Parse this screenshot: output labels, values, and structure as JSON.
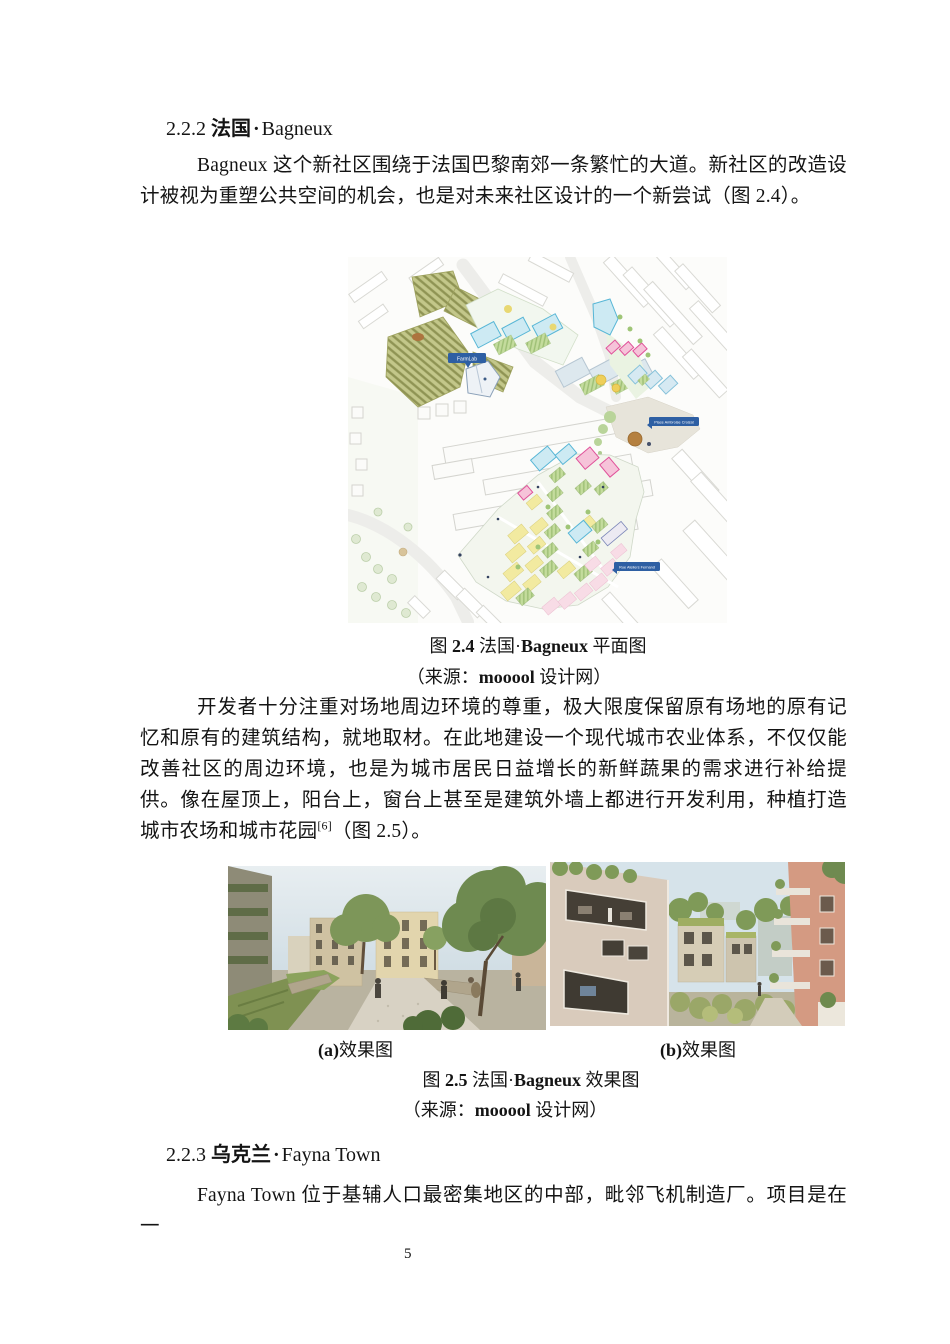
{
  "page": {
    "number": "5"
  },
  "headings": {
    "s222": {
      "num": "2.2.2 ",
      "cn": "法国",
      "sep": "·",
      "en": "Bagneux"
    },
    "s223": {
      "num": "2.2.3 ",
      "cn": "乌克兰",
      "sep": "·",
      "en": "Fayna Town"
    }
  },
  "paragraphs": {
    "p1": "Bagneux 这个新社区围绕于法国巴黎南郊一条繁忙的大道。新社区的改造设计被视为重塑公共空间的机会，也是对未来社区设计的一个新尝试（图 2.4）。",
    "p2_main": "开发者十分注重对场地周边环境的尊重，极大限度保留原有场地的原有记忆和原有的建筑结构，就地取材。在此地建设一个现代城市农业体系，不仅仅能改善社区的周边环境，也是为城市居民日益增长的新鲜蔬果的需求进行补给提供。像在屋顶上，阳台上，窗台上甚至是建筑外墙上都进行开发利用，种植打造城市农场和城市花园",
    "p2_ref": "[6]",
    "p2_tail": "（图 2.5）。",
    "p3": "Fayna Town 位于基辅人口最密集地区的中部，毗邻飞机制造厂。项目是在一"
  },
  "figure24": {
    "caption_fig": "图 ",
    "caption_num": "2.4",
    "caption_mid": " 法国·",
    "caption_name": "Bagneux",
    "caption_tail": " 平面图",
    "source_pre": "（来源：",
    "source_bold": "mooool",
    "source_tail": " 设计网）",
    "map_labels": {
      "farmlab": "FarmLab",
      "place": "Place Ambroise Croizat",
      "rue": "Rue Ateliers Fernand"
    }
  },
  "figure25": {
    "sub_a_bold": "(a)",
    "sub_a_text": "效果图",
    "sub_b_bold": "(b)",
    "sub_b_text": "效果图",
    "caption_fig": "图 ",
    "caption_num": "2.5",
    "caption_mid": " 法国·",
    "caption_name": "Bagneux",
    "caption_tail": " 效果图",
    "source_pre": "（来源：",
    "source_bold": "mooool",
    "source_tail": " 设计网）"
  }
}
